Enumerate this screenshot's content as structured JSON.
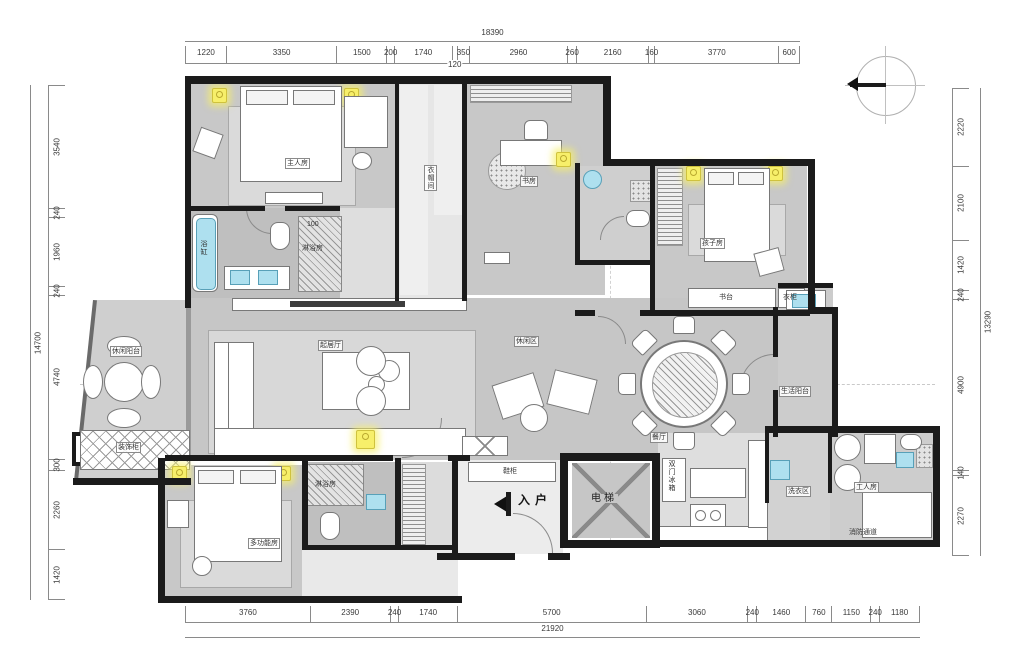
{
  "title": "residential-floor-plan",
  "colors": {
    "wall": "#1b1b1b",
    "floor": "#c8c8c8",
    "accent_lamp": "#f7ef6a",
    "fixture_blue": "#aee0ef"
  },
  "labels": {
    "master": "主人房",
    "closet": "衣帽间",
    "study": "书房",
    "kids": "孩子房",
    "kids_desk": "书台",
    "kids_wardrobe": "衣柜",
    "living": "起居厅",
    "lounge": "休闲区",
    "dining": "餐厅",
    "leisure_balcony": "休闲阳台",
    "decor_cabinet": "装饰柜",
    "bathtub": "浴缸",
    "shower_master": "淋浴房",
    "shower_mf": "淋浴房",
    "multi_room": "多功能房",
    "entry": "入户",
    "elevator": "电梯",
    "shoe_cabinet": "鞋柜",
    "fridge": "双门冰箱",
    "laundry": "洗衣区",
    "staff_room": "工人房",
    "fire_corridor": "消防通道",
    "service_balcony": "生活阳台",
    "dim_100": "100"
  },
  "dimensions": {
    "top": {
      "total": "18390",
      "segments": [
        {
          "v": 1220,
          "t": "1220"
        },
        {
          "v": 3350,
          "t": "3350"
        },
        {
          "v": 1500,
          "t": "1500"
        },
        {
          "v": 200,
          "t": "200"
        },
        {
          "v": 1740,
          "t": "1740"
        },
        {
          "v": 120,
          "t": "120",
          "below": true
        },
        {
          "v": 350,
          "t": "350"
        },
        {
          "v": 2960,
          "t": "2960"
        },
        {
          "v": 260,
          "t": "260"
        },
        {
          "v": 2160,
          "t": "2160"
        },
        {
          "v": 160,
          "t": "160"
        },
        {
          "v": 3770,
          "t": "3770"
        },
        {
          "v": 600,
          "t": "600"
        }
      ]
    },
    "bottom": {
      "total": "21920",
      "segments": [
        {
          "v": 3760,
          "t": "3760"
        },
        {
          "v": 2390,
          "t": "2390"
        },
        {
          "v": 240,
          "t": "240"
        },
        {
          "v": 1740,
          "t": "1740"
        },
        {
          "v": 5700,
          "t": "5700"
        },
        {
          "v": 3060,
          "t": "3060"
        },
        {
          "v": 240,
          "t": "240"
        },
        {
          "v": 1460,
          "t": "1460"
        },
        {
          "v": 760,
          "t": "760"
        },
        {
          "v": 1150,
          "t": "1150"
        },
        {
          "v": 240,
          "t": "240"
        },
        {
          "v": 1180,
          "t": "1180"
        }
      ]
    },
    "left": {
      "total": "14700",
      "segments": [
        {
          "v": 3540,
          "t": "3540"
        },
        {
          "v": 240,
          "t": "240"
        },
        {
          "v": 1960,
          "t": "1960"
        },
        {
          "v": 240,
          "t": "240"
        },
        {
          "v": 4740,
          "t": "4740"
        },
        {
          "v": 300,
          "t": "300"
        },
        {
          "v": 2260,
          "t": "2260"
        },
        {
          "v": 1420,
          "t": "1420"
        }
      ]
    },
    "right": {
      "total": "13290",
      "segments": [
        {
          "v": 2220,
          "t": "2220"
        },
        {
          "v": 2100,
          "t": "2100"
        },
        {
          "v": 1420,
          "t": "1420"
        },
        {
          "v": 240,
          "t": "240"
        },
        {
          "v": 4900,
          "t": "4900"
        },
        {
          "v": 140,
          "t": "140"
        },
        {
          "v": 2270,
          "t": "2270"
        }
      ]
    }
  }
}
